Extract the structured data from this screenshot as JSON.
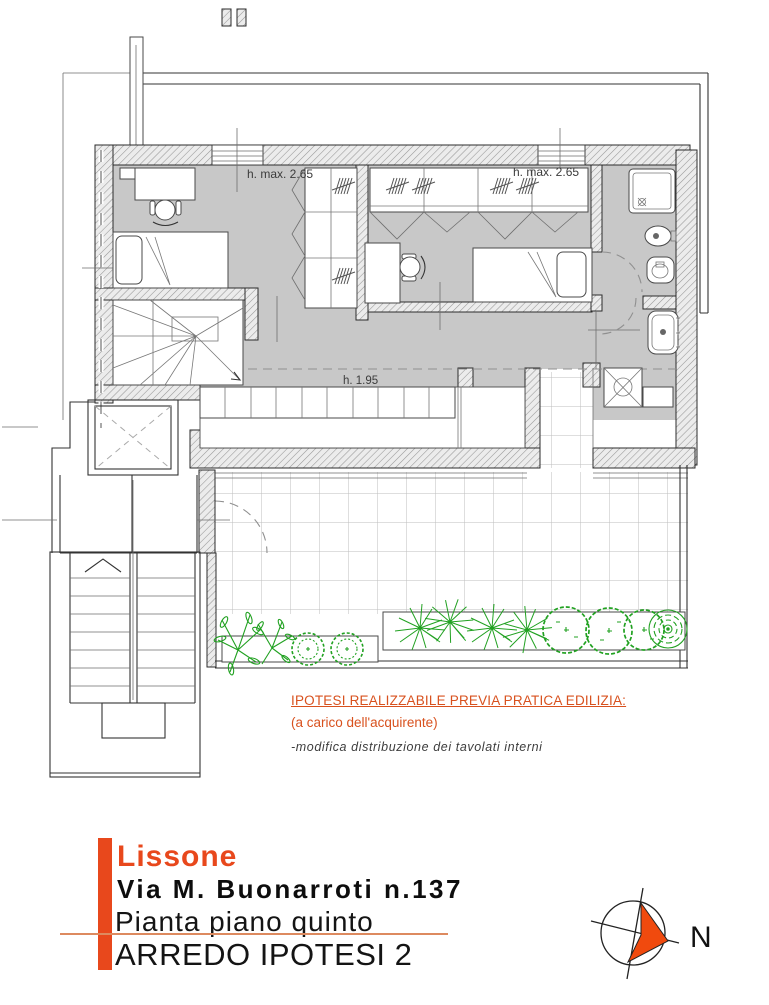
{
  "plan": {
    "label_h_max_left": "h. max. 2.65",
    "label_h_max_right": "h. max. 2.65",
    "label_h_mid": "h. 1.95"
  },
  "notes": {
    "line1": "IPOTESI REALIZZABILE PREVIA PRATICA EDILIZIA:",
    "line2": "(a carico dell'acquirente)",
    "line3": "-modifica distribuzione dei tavolati interni"
  },
  "title_block": {
    "city": "Lissone",
    "address": "Via M. Buonarroti n.137",
    "drawing_title": "Pianta piano quinto",
    "variant": "ARREDO IPOTESI 2"
  },
  "compass": {
    "north": "N"
  },
  "colors": {
    "accent_orange": "#e8481c",
    "note_orange": "#d8511e",
    "floor_gray": "#c8c8c8",
    "plant_green": "#21a121"
  }
}
